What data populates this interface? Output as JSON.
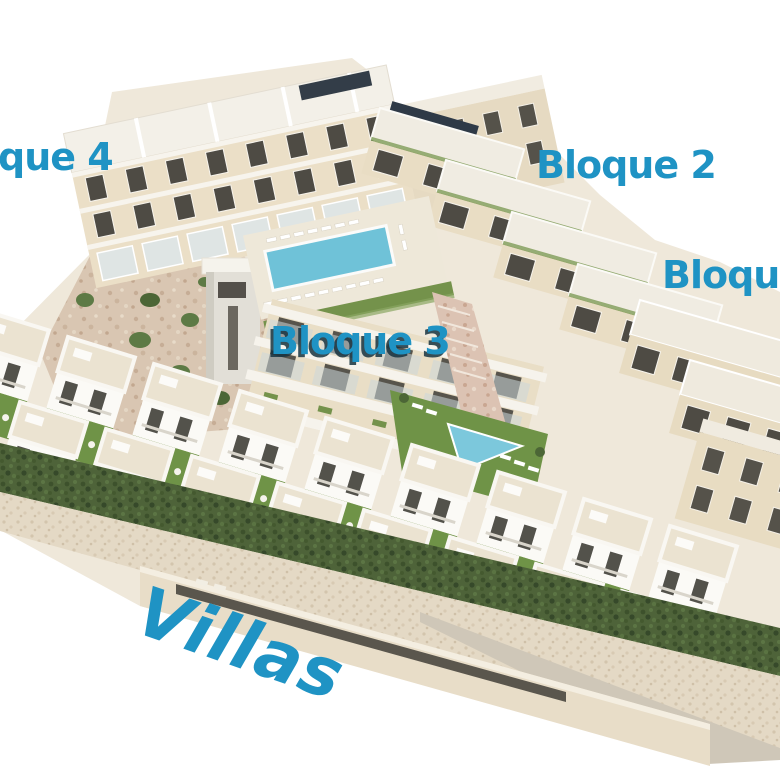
{
  "labels": {
    "bloque4": {
      "text": "que 4"
    },
    "bloque2": {
      "text": "Bloque 2"
    },
    "bloque1": {
      "text": "Bloque"
    },
    "bloque3": {
      "text": "Bloque 3"
    },
    "villas": {
      "text": "Villas"
    }
  },
  "colors": {
    "label_blue": "#1f93c4",
    "bloque3_label_shadow": "#16323f",
    "communal_pool_water": "#6fc2d8",
    "villa_pool_water": "#55b4d2",
    "lawn_green": "#6f9347",
    "hedge_green": "#4e6339",
    "facade_cream": "#eadfc8",
    "roof_white": "#f3f0e8",
    "rock_tan": "#d9c6b2",
    "background": "#ffffff"
  }
}
